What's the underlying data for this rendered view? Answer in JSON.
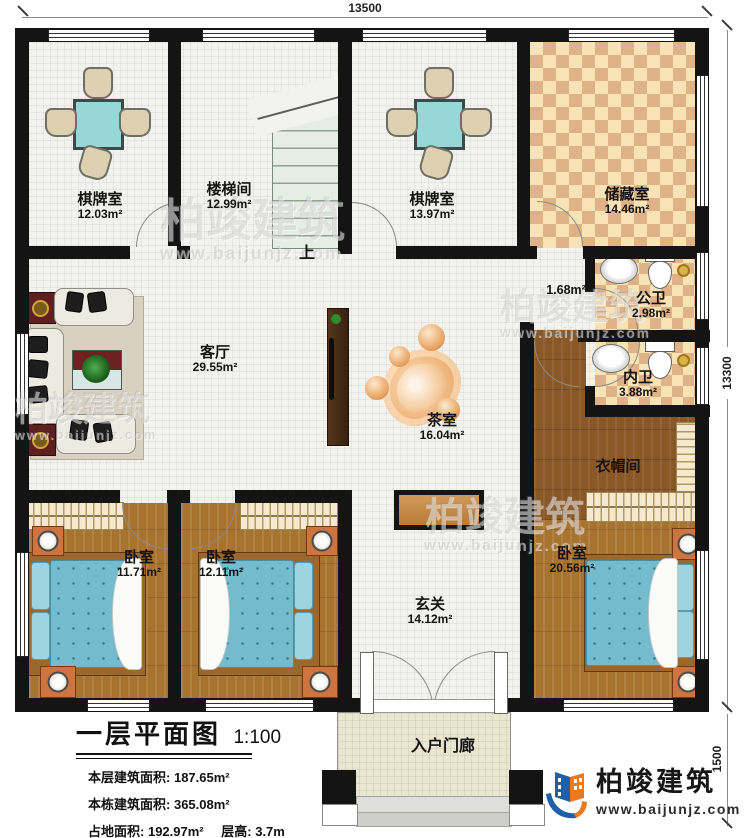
{
  "plan": {
    "title": "一层平面图",
    "scale": "1:100",
    "stairs_up": "上",
    "stats": {
      "line1_label": "本层建筑面积:",
      "line1_value": "187.65m²",
      "line2_label": "本栋建筑面积:",
      "line2_value": "365.08m²",
      "line3a_label": "占地面积:",
      "line3a_value": "192.97m²",
      "line3b_label": "层高:",
      "line3b_value": "3.7m"
    }
  },
  "dimensions": {
    "top": "13500",
    "right": "13300",
    "porch": "1500"
  },
  "rooms": {
    "qipaishi1": {
      "name": "棋牌室",
      "area": "12.03m²"
    },
    "loutijian": {
      "name": "楼梯间",
      "area": "12.99m²"
    },
    "qipaishi2": {
      "name": "棋牌室",
      "area": "13.97m²"
    },
    "chucangshi": {
      "name": "储藏室",
      "area": "14.46m²"
    },
    "hall_nook": {
      "area": "1.68m²"
    },
    "gongwei": {
      "name": "公卫",
      "area": "2.98m²"
    },
    "neiwei": {
      "name": "内卫",
      "area": "3.88m²"
    },
    "yimaojian": {
      "name": "衣帽间"
    },
    "keting": {
      "name": "客厅",
      "area": "29.55m²"
    },
    "chashi": {
      "name": "茶室",
      "area": "16.04m²"
    },
    "woshi1": {
      "name": "卧室",
      "area": "11.71m²"
    },
    "woshi2": {
      "name": "卧室",
      "area": "12.11m²"
    },
    "woshi_master": {
      "name": "卧室",
      "area": "20.56m²"
    },
    "xuanguan": {
      "name": "玄关",
      "area": "14.12m²"
    },
    "menlang": {
      "name": "入户门廊"
    }
  },
  "brand": {
    "name": "柏竣建筑",
    "website": "www.baijunjz.com"
  },
  "colors": {
    "wall": "#141414",
    "wood": "#a8722f",
    "checker": "#dfb288",
    "mahjong_teal": "#96d8d8",
    "bed_blue": "#74bccd",
    "accent_blue": "#1d5fa8",
    "accent_orange": "#e87b22"
  }
}
